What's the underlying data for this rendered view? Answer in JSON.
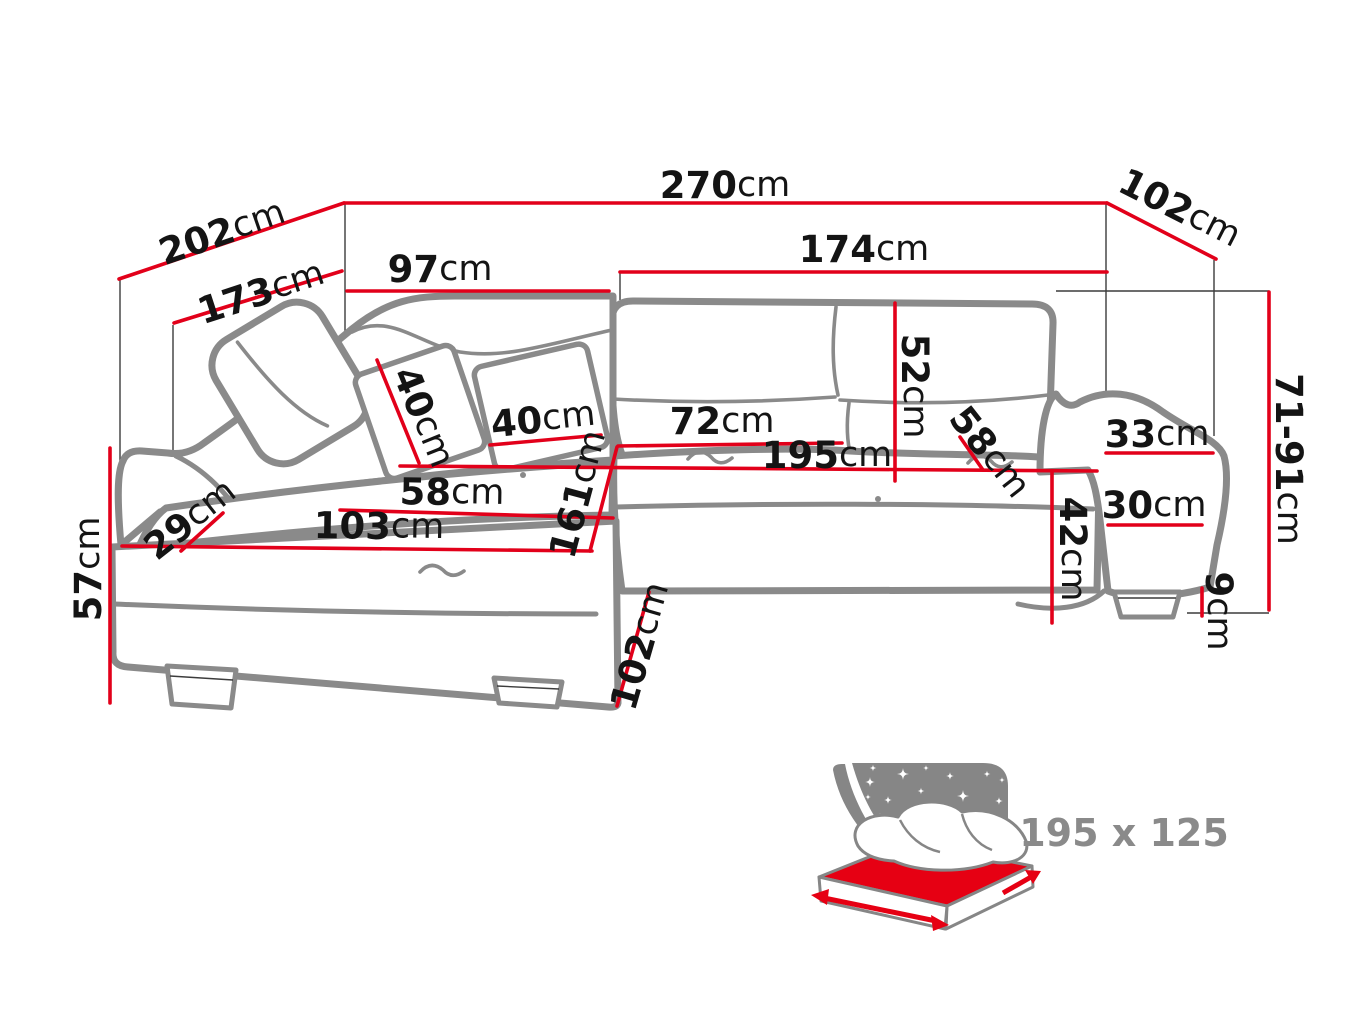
{
  "page": {
    "background": "#ffffff"
  },
  "colors": {
    "dimension_red": "#e2001a",
    "sofa_outline_grey": "#8a8a8a",
    "extension_line_grey": "#3c3c3c",
    "label_text": "#141414",
    "icon_grey": "#868686",
    "icon_red": "#e60013",
    "icon_label_grey": "#8a8a8a"
  },
  "dims": {
    "d270": {
      "v": "270",
      "u": "cm"
    },
    "d202": {
      "v": "202",
      "u": "cm"
    },
    "d102t": {
      "v": "102",
      "u": "cm"
    },
    "d174": {
      "v": "174",
      "u": "cm"
    },
    "d173": {
      "v": "173",
      "u": "cm"
    },
    "d97": {
      "v": "97",
      "u": "cm"
    },
    "d40a": {
      "v": "40",
      "u": "cm"
    },
    "d40b": {
      "v": "40",
      "u": "cm"
    },
    "d72": {
      "v": "72",
      "u": "cm"
    },
    "d195": {
      "v": "195",
      "u": "cm"
    },
    "d52": {
      "v": "52",
      "u": "cm"
    },
    "d58r": {
      "v": "58",
      "u": "cm"
    },
    "d33": {
      "v": "33",
      "u": "cm"
    },
    "d71_91": {
      "v": "71-91",
      "u": "cm"
    },
    "d30": {
      "v": "30",
      "u": "cm"
    },
    "d42": {
      "v": "42",
      "u": "cm"
    },
    "d9": {
      "v": "9",
      "u": "cm"
    },
    "d57": {
      "v": "57",
      "u": "cm"
    },
    "d29": {
      "v": "29",
      "u": "cm"
    },
    "d58l": {
      "v": "58",
      "u": "cm"
    },
    "d103": {
      "v": "103",
      "u": "cm"
    },
    "d161": {
      "v": "161",
      "u": "cm"
    },
    "d102b": {
      "v": "102",
      "u": "cm"
    }
  },
  "bed_icon": {
    "size_label": "195 x 125"
  }
}
